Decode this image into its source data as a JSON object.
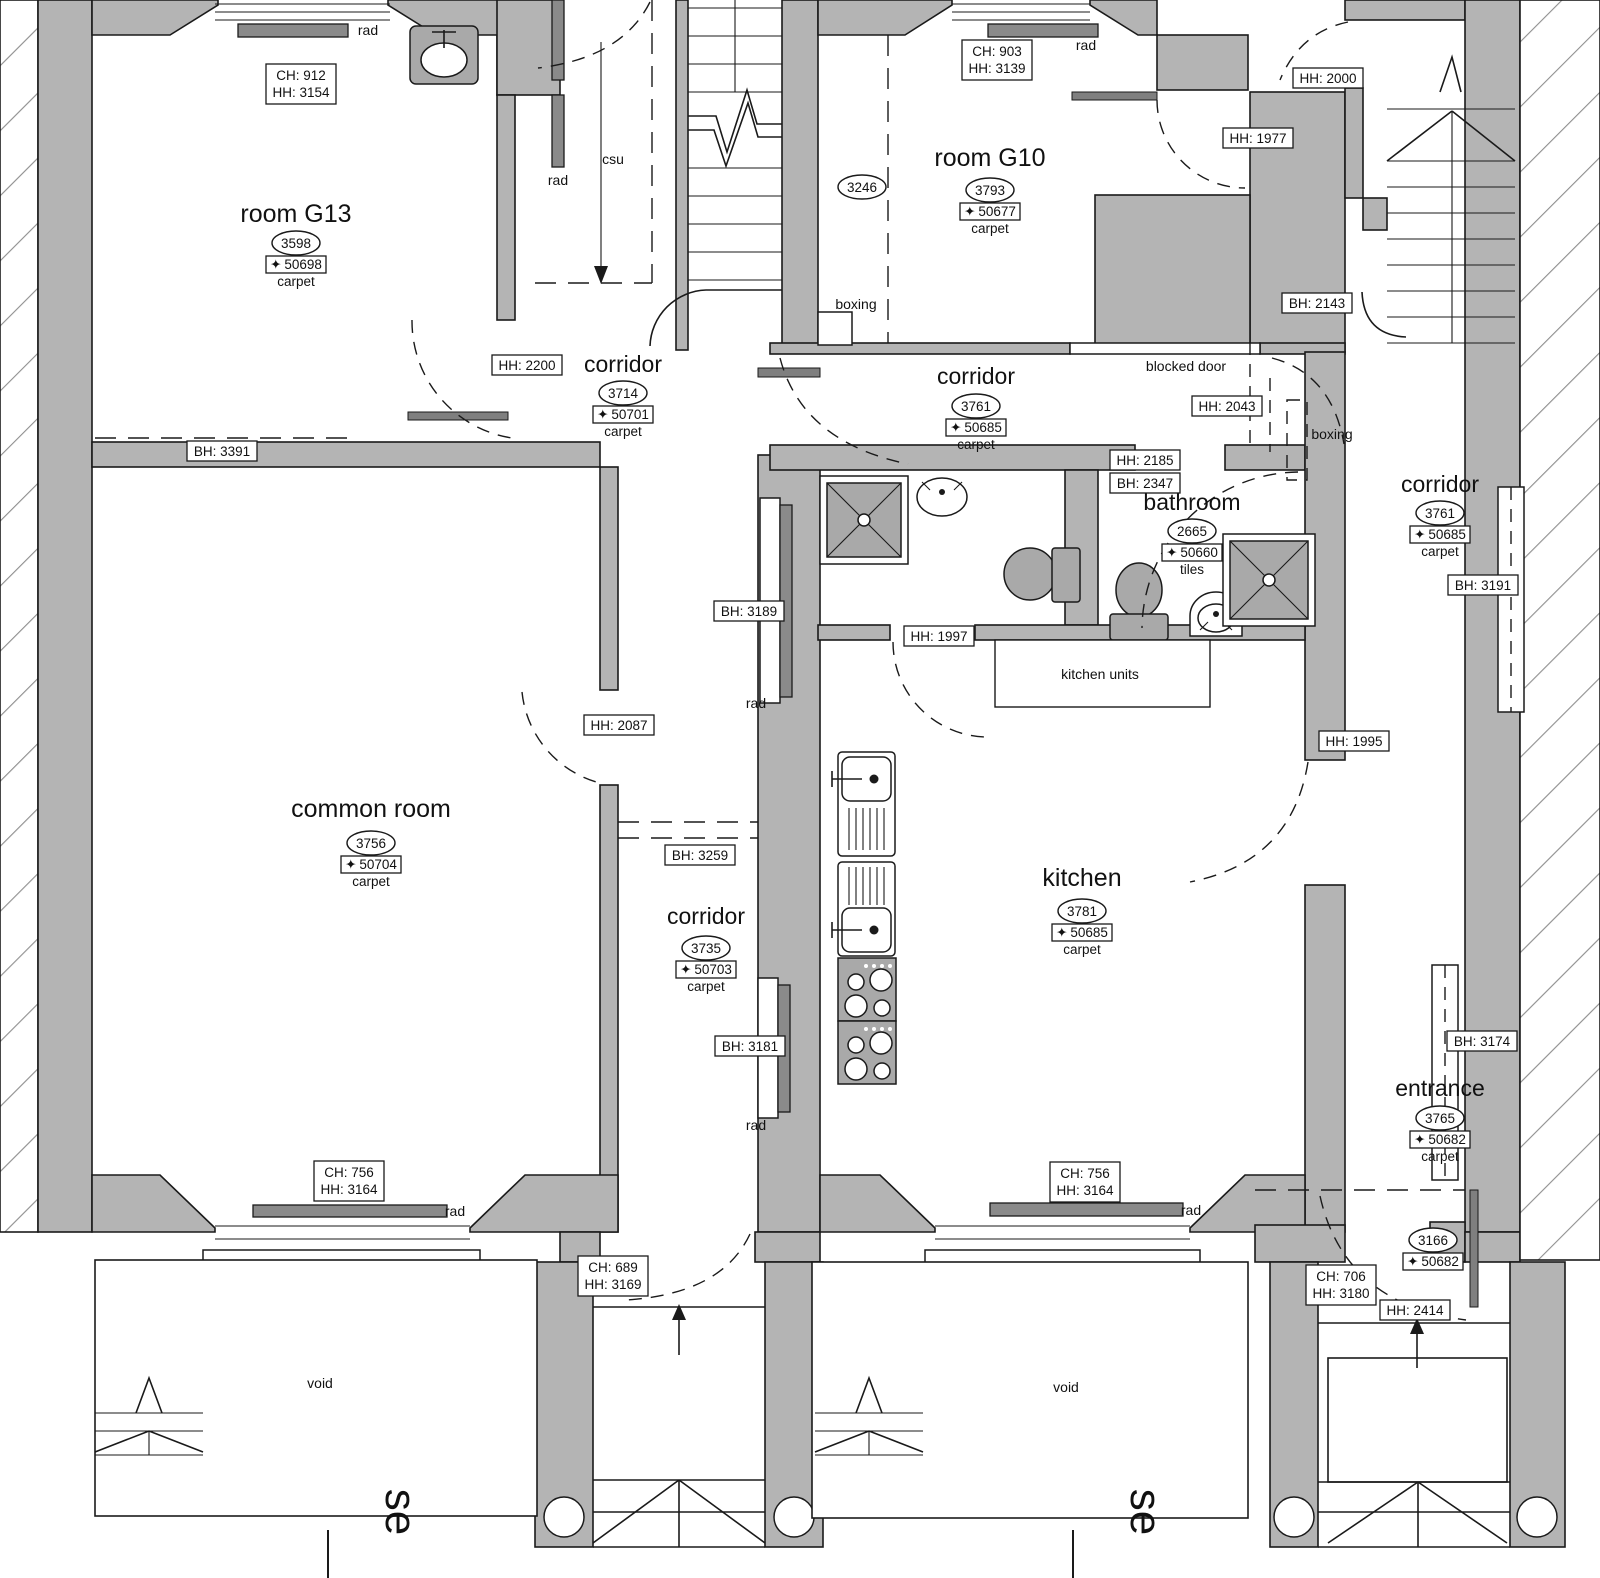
{
  "rooms": {
    "g13": {
      "name": "room G13",
      "area": "3598",
      "level": "50698",
      "floor": "carpet"
    },
    "g10": {
      "name": "room G10",
      "area": "3793",
      "level": "50677",
      "floor": "carpet",
      "secondary_area": "3246"
    },
    "common_room": {
      "name": "common room",
      "area": "3756",
      "level": "50704",
      "floor": "carpet"
    },
    "corridor_upper_left": {
      "name": "corridor",
      "area": "3714",
      "level": "50701",
      "floor": "carpet"
    },
    "corridor_upper_right": {
      "name": "corridor",
      "area": "3761",
      "level": "50685",
      "floor": "carpet"
    },
    "corridor_east": {
      "name": "corridor",
      "area": "3761",
      "level": "50685",
      "floor": "carpet"
    },
    "corridor_lower": {
      "name": "corridor",
      "area": "3735",
      "level": "50703",
      "floor": "carpet"
    },
    "kitchen": {
      "name": "kitchen",
      "area": "3781",
      "level": "50685",
      "floor": "carpet"
    },
    "bathroom": {
      "name": "bathroom",
      "area": "2665",
      "level": "50660",
      "floor": "tiles"
    },
    "entrance": {
      "name": "entrance",
      "area": "3765",
      "level": "50682",
      "floor": "carpet"
    },
    "vestibule": {
      "area": "3166",
      "level": "50682"
    }
  },
  "measurements": {
    "g13_window": {
      "line1": "CH: 912",
      "line2": "HH: 3154"
    },
    "g13_breast": {
      "line1": "BH: 3391"
    },
    "corridor_ul_head": {
      "line1": "HH: 2200"
    },
    "g10_window": {
      "line1": "CH: 903",
      "line2": "HH: 3139"
    },
    "door_hh2000": {
      "line1": "HH: 2000"
    },
    "door_hh1977": {
      "line1": "HH: 1977"
    },
    "breast_bh2143": {
      "line1": "BH: 2143"
    },
    "door_hh2043": {
      "line1": "HH: 2043"
    },
    "door_hh2185": {
      "line1": "HH: 2185"
    },
    "breast_bh2347": {
      "line1": "BH: 2347"
    },
    "breast_bh3189": {
      "line1": "BH: 3189"
    },
    "door_hh1997": {
      "line1": "HH: 1997"
    },
    "door_hh2087": {
      "line1": "HH: 2087"
    },
    "breast_bh3259": {
      "line1": "BH: 3259"
    },
    "breast_bh3181": {
      "line1": "BH: 3181"
    },
    "breast_bh3191": {
      "line1": "BH: 3191"
    },
    "door_hh1995": {
      "line1": "HH: 1995"
    },
    "breast_bh3174": {
      "line1": "BH: 3174"
    },
    "bay_left": {
      "line1": "CH: 756",
      "line2": "HH: 3164"
    },
    "bay_right": {
      "line1": "CH: 756",
      "line2": "HH: 3164"
    },
    "door_left_front": {
      "line1": "CH: 689",
      "line2": "HH: 3169"
    },
    "door_right_front": {
      "line1": "CH: 706",
      "line2": "HH: 3180"
    },
    "door_hh2414": {
      "line1": "HH: 2414"
    }
  },
  "annotations": {
    "rad": "rad",
    "csu": "csu",
    "boxing": "boxing",
    "blocked_door": "blocked door",
    "kitchen_units": "kitchen units",
    "void": "void",
    "section_label": "se"
  },
  "icons": {
    "level_marker": "✦"
  },
  "colors": {
    "wall": "#b4b4b4",
    "rad": "#8a8a8a",
    "fixture": "#a9a9a9",
    "line": "#1a1a1a",
    "hatch": "#8f8f8f"
  }
}
